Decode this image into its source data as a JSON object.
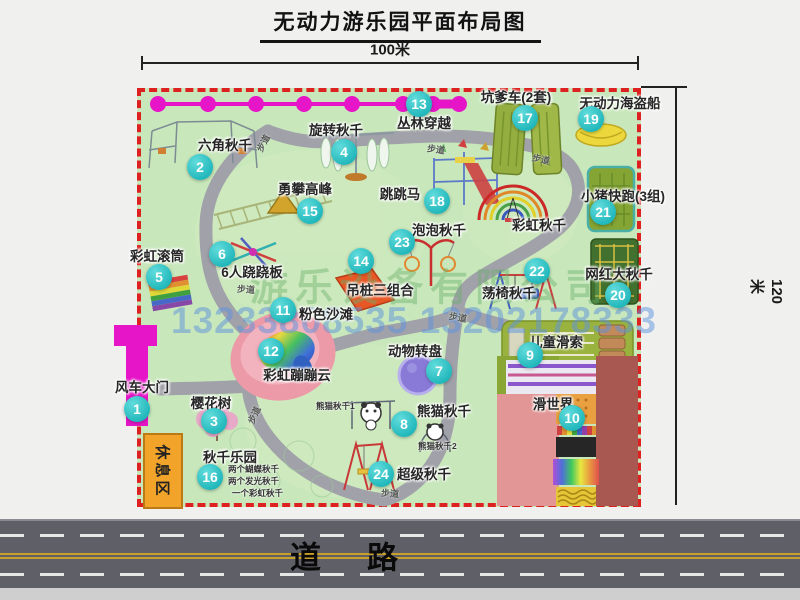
{
  "title": "无动力游乐园平面布局图",
  "dim_top": "100米",
  "dim_right": "120米",
  "road_label": "道路",
  "rest_area_label": "休息区",
  "watermark": {
    "company": "游乐设备有限公司",
    "phones": "13233808535 13202178333"
  },
  "colors": {
    "map_green": "#c8e7bb",
    "border_red": "#dd2020",
    "marker_teal": "#1fb6ba",
    "magenta": "#e616c8",
    "rest_orange": "#f2a32a"
  },
  "attractions": [
    {
      "num": "1",
      "name": "风车大门",
      "mx": 137,
      "my": 409,
      "lx": 142,
      "ly": 386
    },
    {
      "num": "2",
      "name": "六角秋千",
      "mx": 200,
      "my": 167,
      "lx": 225,
      "ly": 144
    },
    {
      "num": "3",
      "name": "樱花树",
      "mx": 214,
      "my": 421,
      "lx": 211,
      "ly": 402
    },
    {
      "num": "4",
      "name": "旋转秋千",
      "mx": 344,
      "my": 152,
      "lx": 336,
      "ly": 129
    },
    {
      "num": "5",
      "name": "彩虹滚筒",
      "mx": 159,
      "my": 277,
      "lx": 157,
      "ly": 255
    },
    {
      "num": "6",
      "name": "6人跷跷板",
      "mx": 222,
      "my": 254,
      "lx": 252,
      "ly": 271
    },
    {
      "num": "7",
      "name": "动物转盘",
      "mx": 439,
      "my": 371,
      "lx": 415,
      "ly": 350
    },
    {
      "num": "8",
      "name": "熊猫秋千",
      "mx": 404,
      "my": 424,
      "lx": 444,
      "ly": 410
    },
    {
      "num": "9",
      "name": "儿童滑索",
      "mx": 530,
      "my": 355,
      "lx": 556,
      "ly": 341
    },
    {
      "num": "10",
      "name": "滑世界",
      "mx": 572,
      "my": 418,
      "lx": 553,
      "ly": 403
    },
    {
      "num": "11",
      "name": "粉色沙滩",
      "mx": 283,
      "my": 310,
      "lx": 326,
      "ly": 313
    },
    {
      "num": "12",
      "name": "彩虹蹦蹦云",
      "mx": 271,
      "my": 351,
      "lx": 297,
      "ly": 374
    },
    {
      "num": "13",
      "name": "丛林穿越",
      "mx": 419,
      "my": 104,
      "lx": 424,
      "ly": 122
    },
    {
      "num": "14",
      "name": "吊桩三组合",
      "mx": 361,
      "my": 261,
      "lx": 380,
      "ly": 289
    },
    {
      "num": "15",
      "name": "勇攀高峰",
      "mx": 310,
      "my": 211,
      "lx": 305,
      "ly": 188
    },
    {
      "num": "16",
      "name": "秋千乐园",
      "mx": 210,
      "my": 477,
      "lx": 230,
      "ly": 456
    },
    {
      "num": "17",
      "name": "坑爹车(2套)",
      "mx": 525,
      "my": 118,
      "lx": 516,
      "ly": 96
    },
    {
      "num": "18",
      "name": "跳跳马",
      "mx": 437,
      "my": 201,
      "lx": 400,
      "ly": 193
    },
    {
      "num": "19",
      "name": "无动力海盗船",
      "mx": 591,
      "my": 119,
      "lx": 620,
      "ly": 102
    },
    {
      "num": "20",
      "name": "网红大秋千",
      "mx": 618,
      "my": 295,
      "lx": 619,
      "ly": 273
    },
    {
      "num": "21",
      "name": "小猪快跑(3组)",
      "mx": 603,
      "my": 212,
      "lx": 623,
      "ly": 195
    },
    {
      "num": "22",
      "name": "荡椅秋千",
      "mx": 537,
      "my": 271,
      "lx": 509,
      "ly": 292
    },
    {
      "num": "23",
      "name": "泡泡秋千",
      "mx": 402,
      "my": 242,
      "lx": 439,
      "ly": 229
    },
    {
      "num": "24",
      "name": "超级秋千",
      "mx": 381,
      "my": 474,
      "lx": 424,
      "ly": 473
    }
  ],
  "extra_labels": [
    {
      "text": "彩虹秋千",
      "x": 539,
      "y": 224
    }
  ],
  "sub_labels": [
    {
      "text": "两个蝴蝶秋千",
      "x": 228,
      "y": 469
    },
    {
      "text": "两个发光秋千",
      "x": 228,
      "y": 481
    },
    {
      "text": "一个彩虹秋千",
      "x": 232,
      "y": 493
    },
    {
      "text": "熊猫秋千1",
      "x": 316,
      "y": 406
    },
    {
      "text": "熊猫秋千2",
      "x": 418,
      "y": 446
    }
  ],
  "path_labels": [
    {
      "text": "步道",
      "x": 263,
      "y": 143,
      "rot": -62
    },
    {
      "text": "步道",
      "x": 436,
      "y": 149,
      "rot": 8
    },
    {
      "text": "步道",
      "x": 541,
      "y": 159,
      "rot": 12
    },
    {
      "text": "步道",
      "x": 246,
      "y": 289,
      "rot": 4
    },
    {
      "text": "步道",
      "x": 458,
      "y": 317,
      "rot": 10
    },
    {
      "text": "步道",
      "x": 254,
      "y": 415,
      "rot": -65
    },
    {
      "text": "步道",
      "x": 390,
      "y": 493,
      "rot": 4
    }
  ]
}
